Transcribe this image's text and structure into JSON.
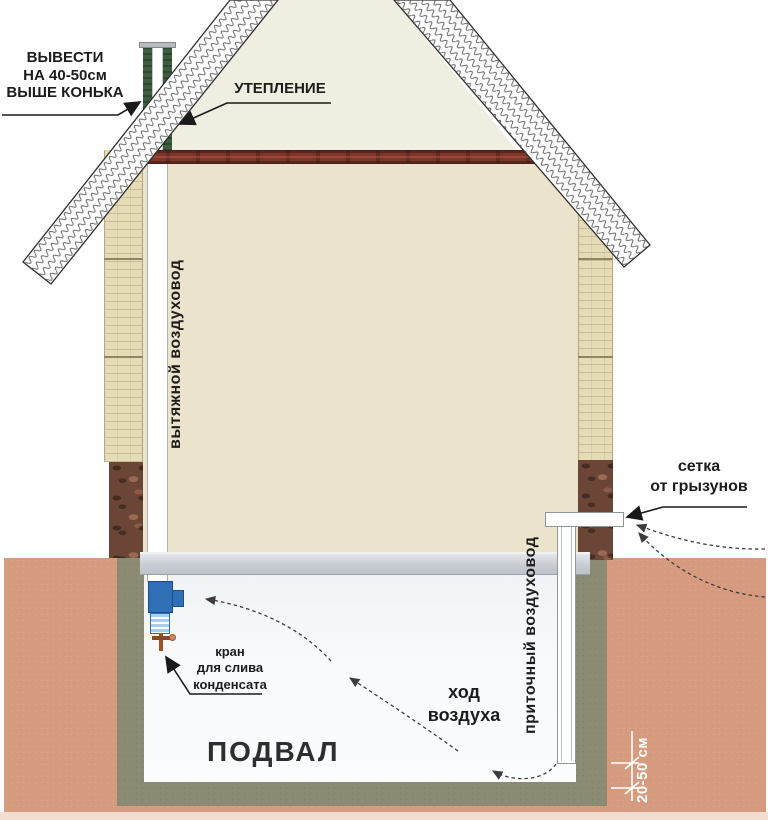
{
  "labels": {
    "vent_above_ridge": "ВЫВЕСТИ\nНА 40-50см\nВЫШЕ КОНЬКА",
    "insulation": "УТЕПЛЕНИЕ",
    "exhaust_duct": "вытяжной воздуховод",
    "rodent_mesh": "сетка\nот грызунов",
    "condensate_valve": "кран\nдля слива\nконденсата",
    "air_flow": "ход\nвоздуха",
    "basement": "ПОДВАЛ",
    "supply_duct": "приточный воздуховод",
    "duct_floor_clearance": "20-50 см"
  },
  "colors": {
    "ground": "#d69b7e",
    "ground_light": "#f3ddd0",
    "foundation": "#8b8a72",
    "brick_wall": "#e6dbb7",
    "stone_base": "#6b4636",
    "attic_floor": "#7e352a",
    "insulation_green": "#3f5d40",
    "fan_unit_blue": "#2f6fb5",
    "floor_slab": "#c9ced4",
    "interior_cream": "#ece3cc",
    "attic_cream": "#f0ede1",
    "basement_white": "#f7f9fb",
    "line_dark": "#1a1a1a",
    "dimension_white": "#ffffff"
  }
}
